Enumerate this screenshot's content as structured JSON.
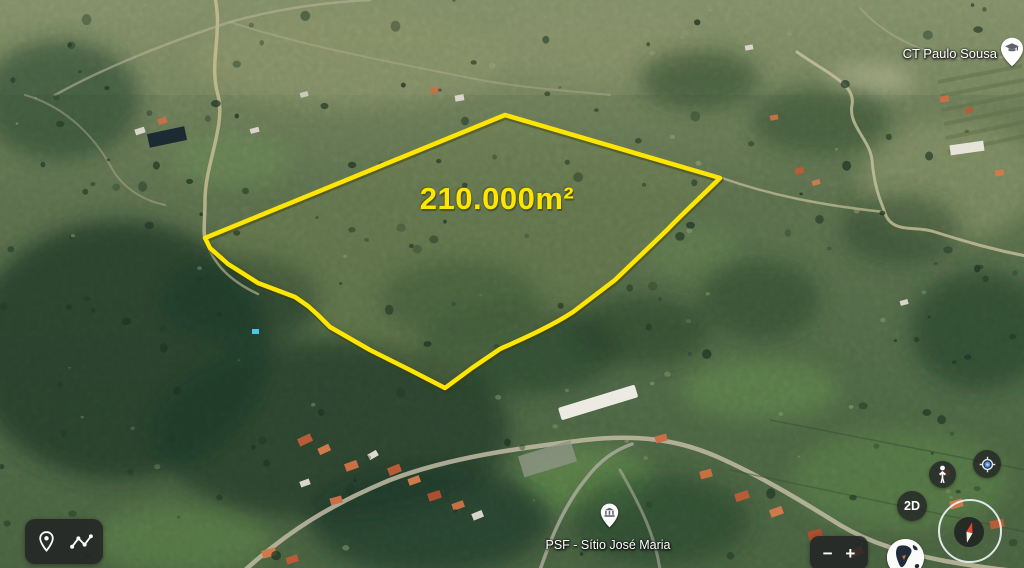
{
  "parcel": {
    "area_label": "210.000m²",
    "outline_color": "#ffe600"
  },
  "pois": {
    "school": {
      "label": "CT Paulo Sousa",
      "icon": "school-pin-icon"
    },
    "health_post": {
      "label": "PSF - Sítio José Maria",
      "icon": "civic-building-pin-icon"
    }
  },
  "toolbar": {
    "pin_tool_icon": "place-marker-icon",
    "measure_tool_icon": "measure-path-icon"
  },
  "controls": {
    "pegman_icon": "pegman-icon",
    "my_location_icon": "my-location-icon",
    "view_mode_label": "2D",
    "compass_icon": "compass-icon",
    "zoom_out_label": "−",
    "zoom_in_label": "+",
    "globe_icon": "globe-icon"
  }
}
